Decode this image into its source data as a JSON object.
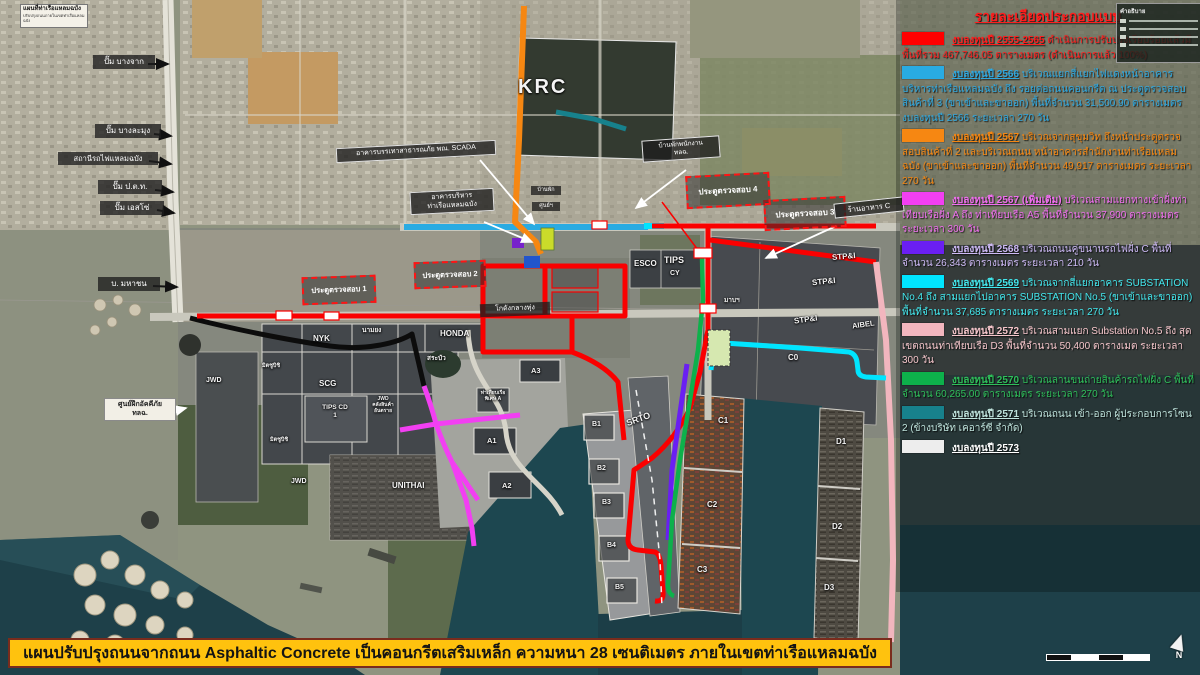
{
  "inset": {
    "title": "แผนที่ท่าเรือแหลมฉบัง",
    "subtitle": "ปรับปรุงถนนภายในเขตท่าเรือแหลมฉบัง"
  },
  "mini_legend": {
    "title": "คำอธิบาย"
  },
  "compass": {
    "label": "N"
  },
  "map_labels": [
    "ปั๊ม บางจาก",
    "ปั๊ม บางละมุง",
    "สถานีรถไฟแหลมฉบัง",
    "ปั๊ม ป.ต.ท.",
    "ปั๊ม เอสโซ่",
    "บ. มหาชน",
    "อาคารบรรเทาสาธารณภัย พณ. SCADA",
    "อาคารบริหาร\nท่าเรือแหลมฉบัง",
    "KRC",
    "บ้านพักพนักงาน\nทลฉ.",
    "ประตูตรวจสอบ 1",
    "ประตูตรวจสอบ 2",
    "ประตูตรวจสอบ 3",
    "ประตูตรวจสอบ 4",
    "ร้านอาหาร C",
    "ESCO",
    "TIPS",
    "CY",
    "STP&I",
    "STP&I",
    "STP&I",
    "AIBEL",
    "C0",
    "SRTO",
    "B1",
    "B2",
    "B3",
    "B4",
    "B5",
    "C1",
    "C2",
    "C3",
    "D1",
    "D2",
    "D3",
    "NYK",
    "นามยง",
    "HONDA",
    "สระบัว",
    "SCG",
    "TIPS CD\n1",
    "JWD\nคลังสินค้า\nอันตราย",
    "มิตซูบิชิ",
    "มิตซูบิชิ",
    "JWD",
    "JWD",
    "UNITHAI",
    "A1",
    "A2",
    "A3",
    "ท่าเทียบเรือ\nพิเศษ A",
    "ศูนย์ฝึกอัคคีภัย\nทลฉ.",
    "โกดังกลางทุ่ง",
    "บ้านพัก",
    "ศูนย์ฯ",
    "มาบฯ"
  ],
  "legend": {
    "title": "รายละเอียดประกอบแบบ",
    "title_color": "#FF1E1E",
    "items": [
      {
        "color": "#FF0000",
        "text_color": "#FF1E1E",
        "head": "งบลงทุนปี 2555-2565",
        "rest": "ดำเนินการปรับปรุงเรียบร้อยแล้วมีพื้นที่รวม 467,746.05 ตารางเมตร (ดำเนินการแล้ว 100%)"
      },
      {
        "color": "#29ABE2",
        "text_color": "#2FA8E0",
        "head": "งบลงทุนปี 2566",
        "rest": "บริเวณแยกสี่แยกไฟแดงหน้าอาคารบริหารท่าเรือแหลมฉบัง ถึง รอยต่อถนนคอนกรีต ณ ประตูตรวจสอบสินค้าที่ 3 (ขาเข้าและขาออก) พื้นที่จำนวน 31,500.90 ตารางเมตร งบลงทุนปี 2566 ระยะเวลา 270 วัน"
      },
      {
        "color": "#F68712",
        "text_color": "#F68712",
        "head": "งบลงทุนปี 2567",
        "rest": "บริเวณจากสุขุมวิท ถึงหน้าประตูตรวจสอบสินค้าที่ 2 และบริเวณถนน หน้าอาคารสำนักงานท่าเรือแหลมฉบัง (ขาเข้าและขาออก) พื้นที่จำนวน 49,917 ตารางเมตร ระยะเวลา 270 วัน"
      },
      {
        "color": "#F23FF2",
        "text_color": "#F06EF0",
        "head": "งบลงทุนปี 2567 (เพิ่มเติม)",
        "rest": "บริเวณสามแยกทางเข้าฝั่งท่าเทียบเรือฝั่ง A ถึง ท่าเทียบเรือ A5 พื้นที่จำนวน 37,900 ตารางเมตร ระยะเวลา 300 วัน"
      },
      {
        "color": "#6A1FF2",
        "text_color": "#CDB9F5",
        "head": "งบลงทุนปี 2568",
        "rest": "บริเวณถนนคู่ขนานรถไฟฝั่ง C พื้นที่จำนวน 26,343 ตารางเมตร ระยะเวลา 210 วัน"
      },
      {
        "color": "#00E5FF",
        "text_color": "#43E8EE",
        "head": "งบลงทุนปี 2569",
        "rest": "บริเวณจากสี่แยกอาคาร SUBSTATION No.4 ถึง สามแยกไปอาคาร SUBSTATION No.5 (ขาเข้าและขาออก) พื้นที่จำนวน 37,685 ตารางเมตร ระยะเวลา 270 วัน"
      },
      {
        "color": "#F2B6BE",
        "text_color": "#F5C6CB",
        "head": "งบลงทุนปี 2572",
        "rest": "บริเวณสามแยก Substation No.5 ถึง สุดเขตถนนท่าเทียบเรือ D3 พื้นที่จำนวน 50,400 ตารางเมต ระยะเวลา 300 วัน"
      },
      {
        "color": "#0DB14B",
        "text_color": "#2FBF5A",
        "head": "งบลงทุนปี 2570",
        "rest": "บริเวณลานขนถ่ายสินค้ารถไฟฝั่ง C พื้นที่จำนวน 60,265.00 ตารางเมตร ระยะเวลา 270 วัน"
      },
      {
        "color": "#17818C",
        "text_color": "#BFE3DC",
        "head": "งบลงทุนปี 2571",
        "rest": "บริเวณถนน เข้า-ออก ผู้ประกอบการโซน 2 (ข้างบริษัท เคอาร์ซี จำกัด)"
      },
      {
        "color": "#EDEDED",
        "text_color": "#FFFFFF",
        "head": "งบลงทุนปี 2573",
        "rest": ""
      }
    ]
  },
  "banner": {
    "text": "แผนปรับปรุงถนนจากถนน Asphaltic Concrete เป็นคอนกรีตเสริมเหล็ก ความหนา 28 เซนติเมตร ภายในเขตท่าเรือแหลมฉบัง"
  }
}
